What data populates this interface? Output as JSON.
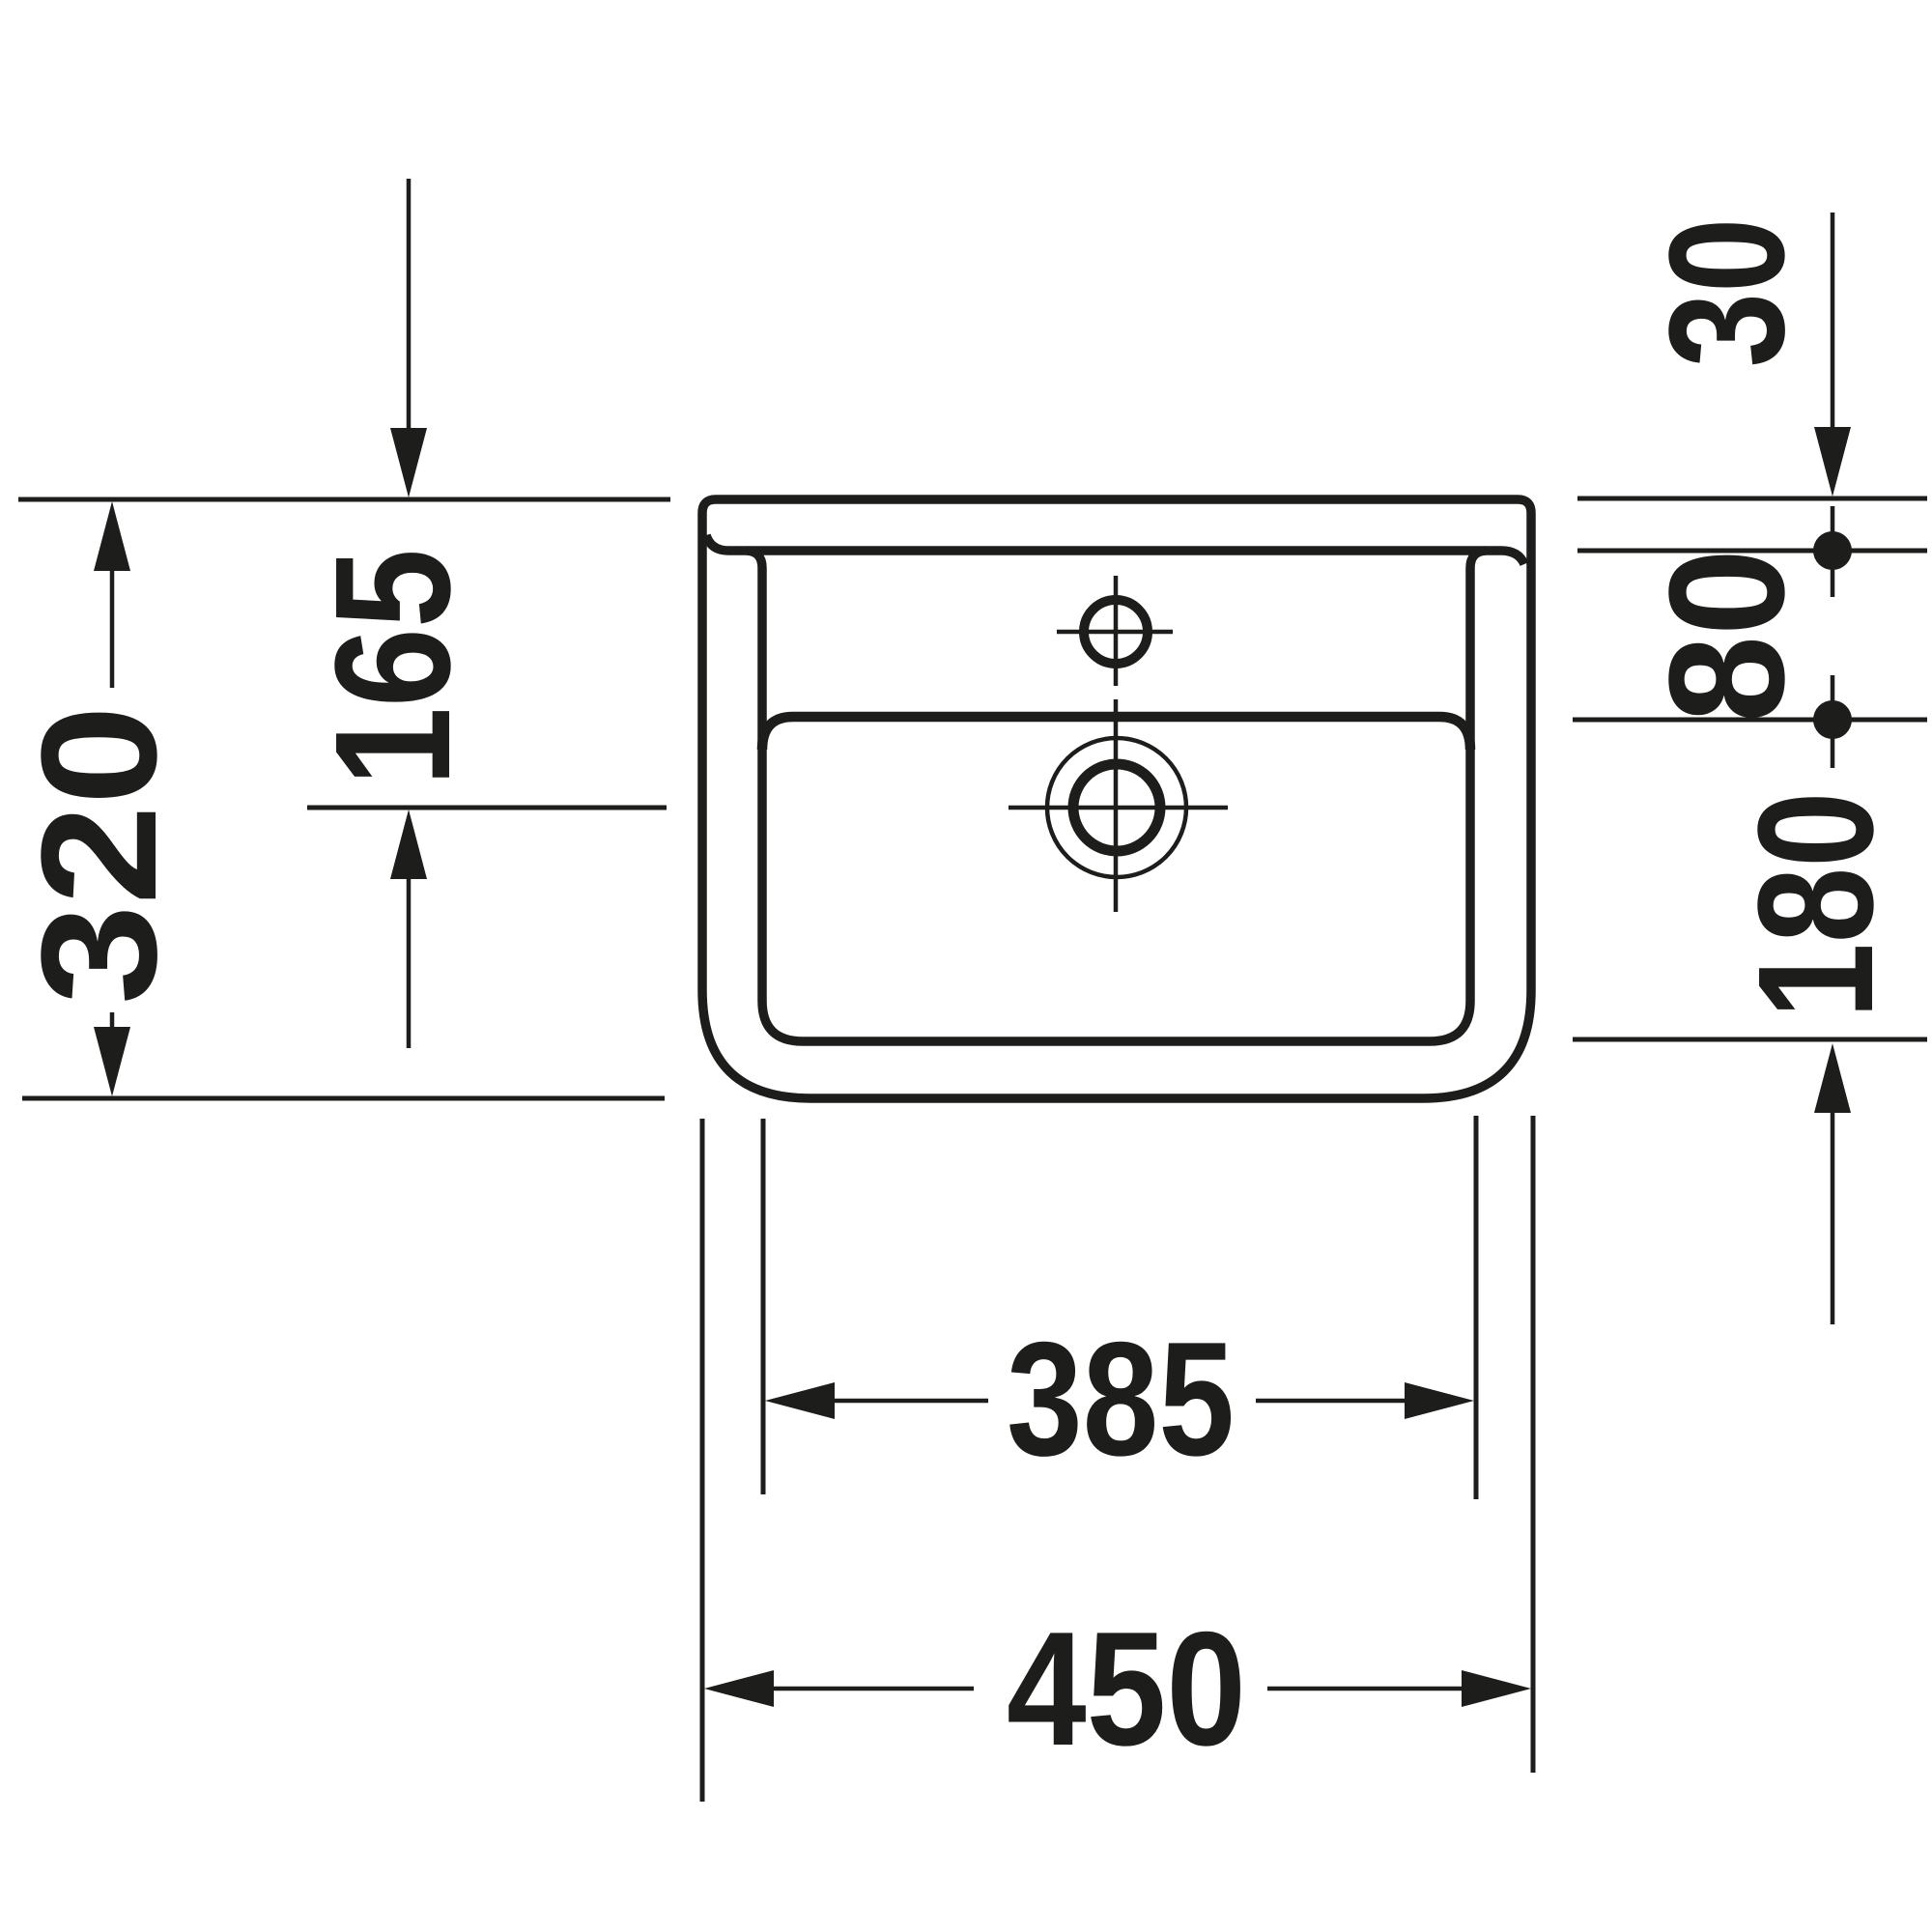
{
  "drawing": {
    "background": "#ffffff",
    "ink": "#1d1d1b",
    "dimensions": {
      "total_height": "320",
      "drain_center_from_top": "165",
      "top_to_first_hole": "30",
      "hole_spacing": "80",
      "hole_to_bottom": "180",
      "bowl_width": "385",
      "overall_width": "450"
    }
  }
}
